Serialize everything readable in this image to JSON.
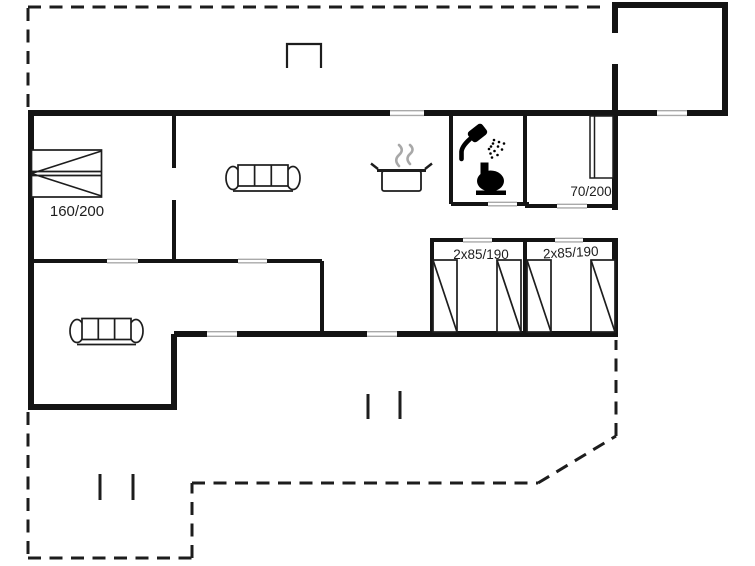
{
  "floorplan": {
    "type": "floor-plan",
    "labels": {
      "double_bed": "160/200",
      "single_bed": "70/200",
      "bunk_bed_left": "2x85/190",
      "bunk_bed_right": "2x85/190"
    },
    "colors": {
      "wall": "#141414",
      "line": "#1d1d1d",
      "opening_marker": "#a9a9a9",
      "steam": "#a8a8a8",
      "fixture_fill": "#000000",
      "background": "#ffffff"
    },
    "icons": [
      "double-bed-icon",
      "single-bed-icon",
      "bunk-bed-icon",
      "sofa-icon",
      "cooking-pot-icon",
      "steam-icon",
      "shower-icon",
      "toilet-icon",
      "entrance-marker",
      "terrace-dashed-outline",
      "terrace-post"
    ]
  }
}
